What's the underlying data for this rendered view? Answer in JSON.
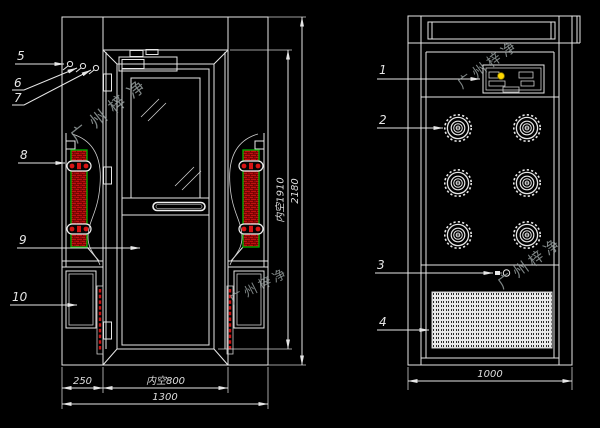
{
  "colors": {
    "background": "#000000",
    "line": "#e6e6e6",
    "red": "#cc1010",
    "dark_red": "#6b0000",
    "green": "#00b400",
    "yellow": "#ffd700",
    "watermark": "#9aa3a3"
  },
  "watermark": {
    "text": "广州梓净"
  },
  "front_view": {
    "callouts": {
      "c5": "5",
      "c6": "6",
      "c7": "7",
      "c8": "8",
      "c9": "9",
      "c10": "10"
    },
    "dims": {
      "width_left": "250",
      "width_door_clear": "内空800",
      "width_total": "1300",
      "height_clear": "内空1910",
      "height_total": "2180"
    }
  },
  "side_view": {
    "callouts": {
      "c1": "1",
      "c2": "2",
      "c3": "3",
      "c4": "4"
    },
    "dims": {
      "depth_total": "1000"
    }
  }
}
